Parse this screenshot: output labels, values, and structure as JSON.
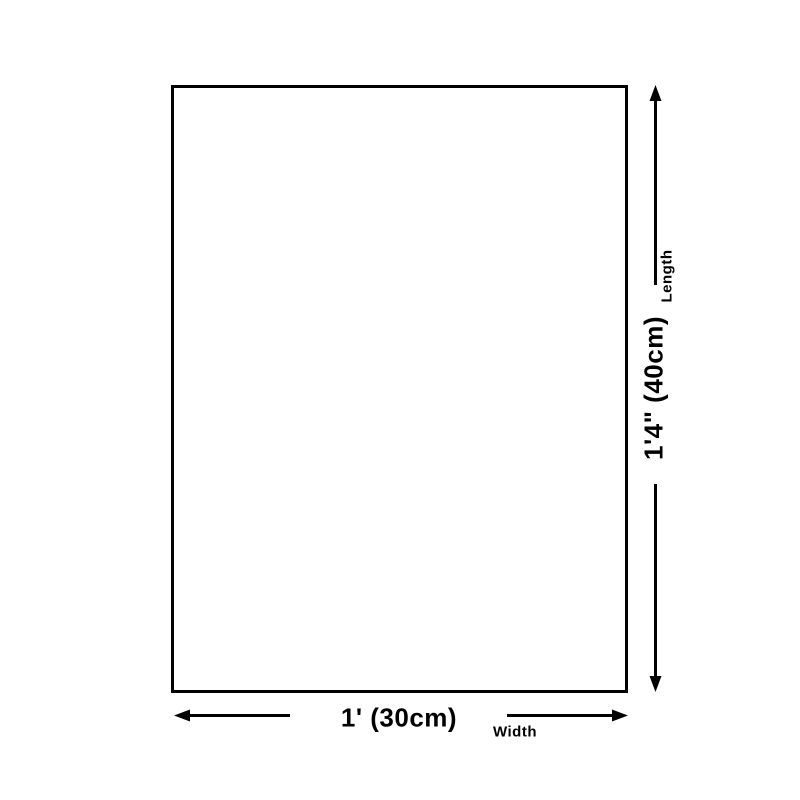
{
  "diagram": {
    "name": "product-size-diagram",
    "background": "#ffffff",
    "stroke_color": "#000000",
    "text_color": "#000000",
    "length": {
      "label": "Length",
      "value": "1'4\" (40cm)"
    },
    "width": {
      "label": "Width",
      "value": "1' (30cm)"
    }
  }
}
